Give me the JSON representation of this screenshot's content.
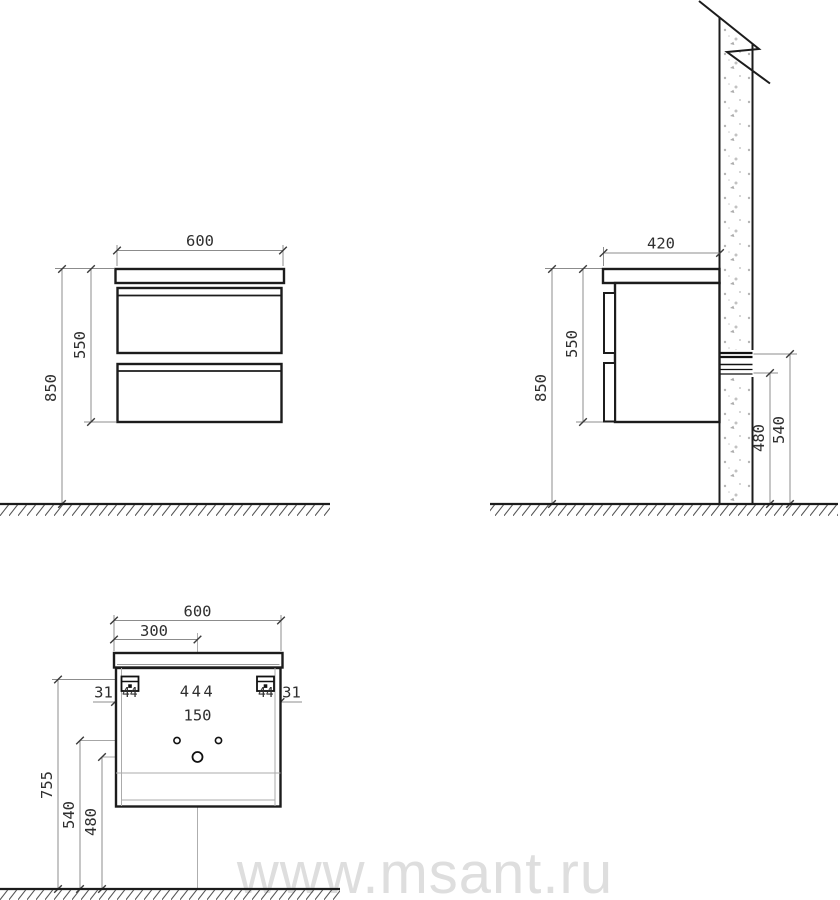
{
  "watermark": {
    "text": "www.msant.ru",
    "color": "#dedede"
  },
  "colors": {
    "object_line": "#1c1c1c",
    "dimension_line": "#8c8c8c",
    "dimension_text": "#2f2f2f",
    "wall_speckle": "#b5b5b5",
    "background": "#ffffff"
  },
  "front_view": {
    "width_mm": "600",
    "cabinet_height_mm": "550",
    "overall_height_mm": "850"
  },
  "side_view": {
    "depth_mm": "420",
    "cabinet_height_mm": "550",
    "overall_height_mm": "850",
    "rail_upper_mm": "540",
    "rail_lower_mm": "480"
  },
  "back_view": {
    "width_mm": "600",
    "center_offset_mm": "300",
    "edge_gap_left_mm": "31",
    "bracket_left_mm": "44",
    "bracket_span_mm": "444",
    "bracket_right_mm": "44",
    "edge_gap_right_mm": "31",
    "hole_spacing_mm": "150",
    "hanger_height_mm": "755",
    "holes_height_mm": "540",
    "drain_height_mm": "480"
  }
}
